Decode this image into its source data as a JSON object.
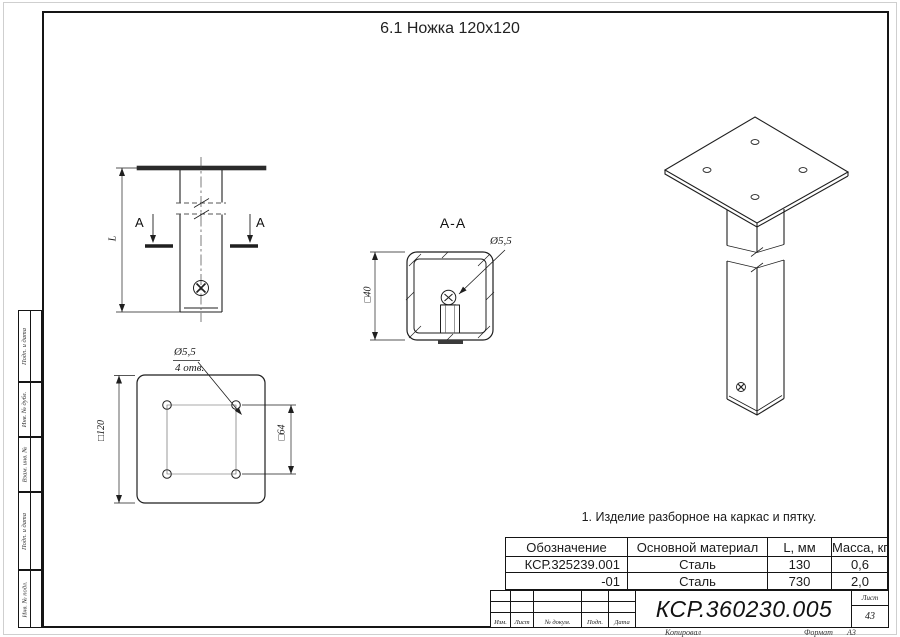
{
  "page": {
    "title": "6.1 Ножка 120х120"
  },
  "side_panel": {
    "items": [
      {
        "label": "Подп. и дата"
      },
      {
        "label": "Инв. № дубл."
      },
      {
        "label": "Взам. инв. №"
      },
      {
        "label": "Подп. и дата"
      },
      {
        "label": "Инв. № подл."
      }
    ]
  },
  "views": {
    "front": {
      "section_letter_left": "А",
      "section_letter_right": "А",
      "length_dim": "L"
    },
    "section": {
      "label": "А-А",
      "hole_dim": "Ø5,5",
      "size_dim": "□40"
    },
    "plate": {
      "hole_dim": "Ø5,5",
      "hole_count": "4 отв.",
      "outer_dim": "□120",
      "pattern_dim": "□64"
    }
  },
  "note": "1. Изделие разборное на каркас и пятку.",
  "spec_table": {
    "headers": [
      "Обозначение",
      "Основной материал",
      "L, мм",
      "Масса, кг"
    ],
    "rows": [
      [
        "КСР.325239.001",
        "Сталь",
        "130",
        "0,6"
      ],
      [
        "-01",
        "Сталь",
        "730",
        "2,0"
      ]
    ]
  },
  "title_block": {
    "doc_number": "КСР.360230.005",
    "bottom_labels": [
      "Изм.",
      "Лист",
      "№ докум.",
      "Подп.",
      "Дата"
    ],
    "sheet_label": "Лист",
    "sheet_number": "43",
    "copied_label": "Копировал",
    "format_label": "Формат",
    "format_value": "А3"
  }
}
